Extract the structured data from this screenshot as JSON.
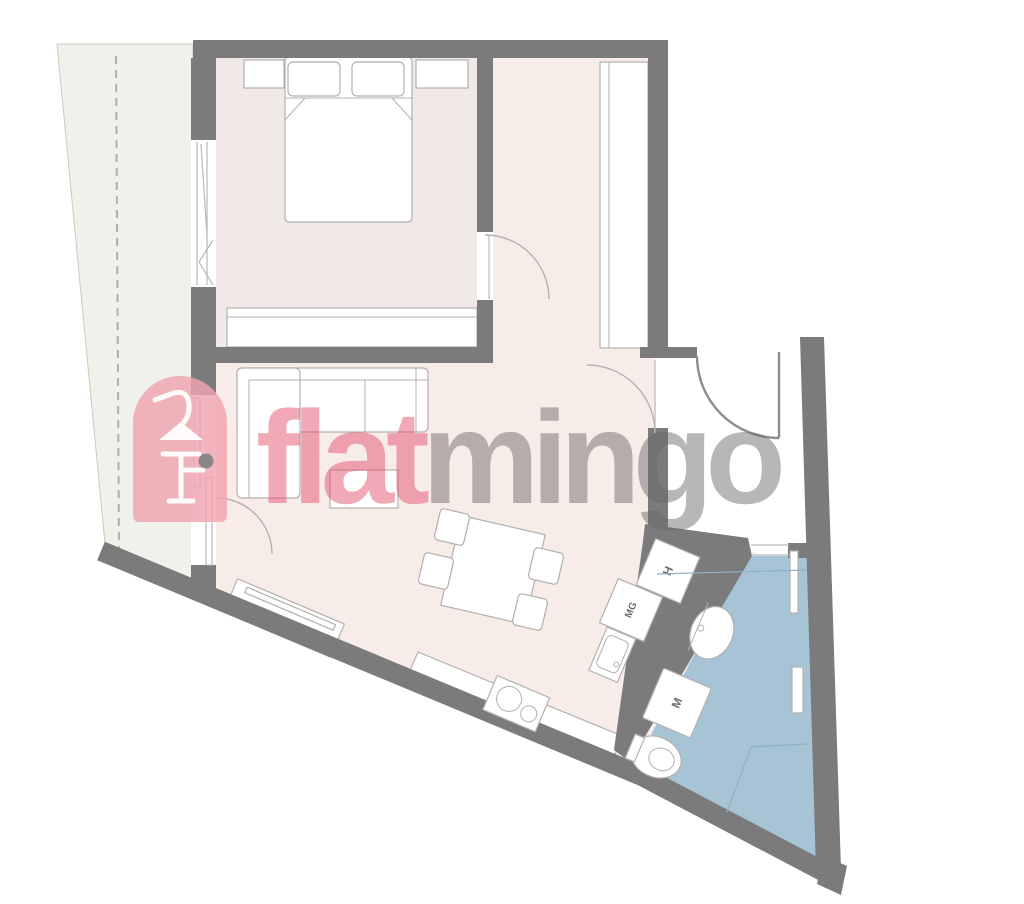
{
  "logo": {
    "icon": "flamingo-icon",
    "first": "flat",
    "second": "mingo"
  },
  "labels": {
    "h": "H",
    "mg": "MG",
    "m": "M"
  },
  "colors": {
    "wall": "#7b7b7b",
    "floor-living": "#f8ece9",
    "floor-bedroom": "#f1e9e8",
    "floor-balcony": "#eff1ea",
    "floor-bath": "#a7c3d6",
    "furniture-stroke": "#b3b0ae",
    "logo-pink": "#f0a3ae",
    "logo-text-pink": "#e4566e",
    "logo-text-gray": "#6e686a"
  }
}
